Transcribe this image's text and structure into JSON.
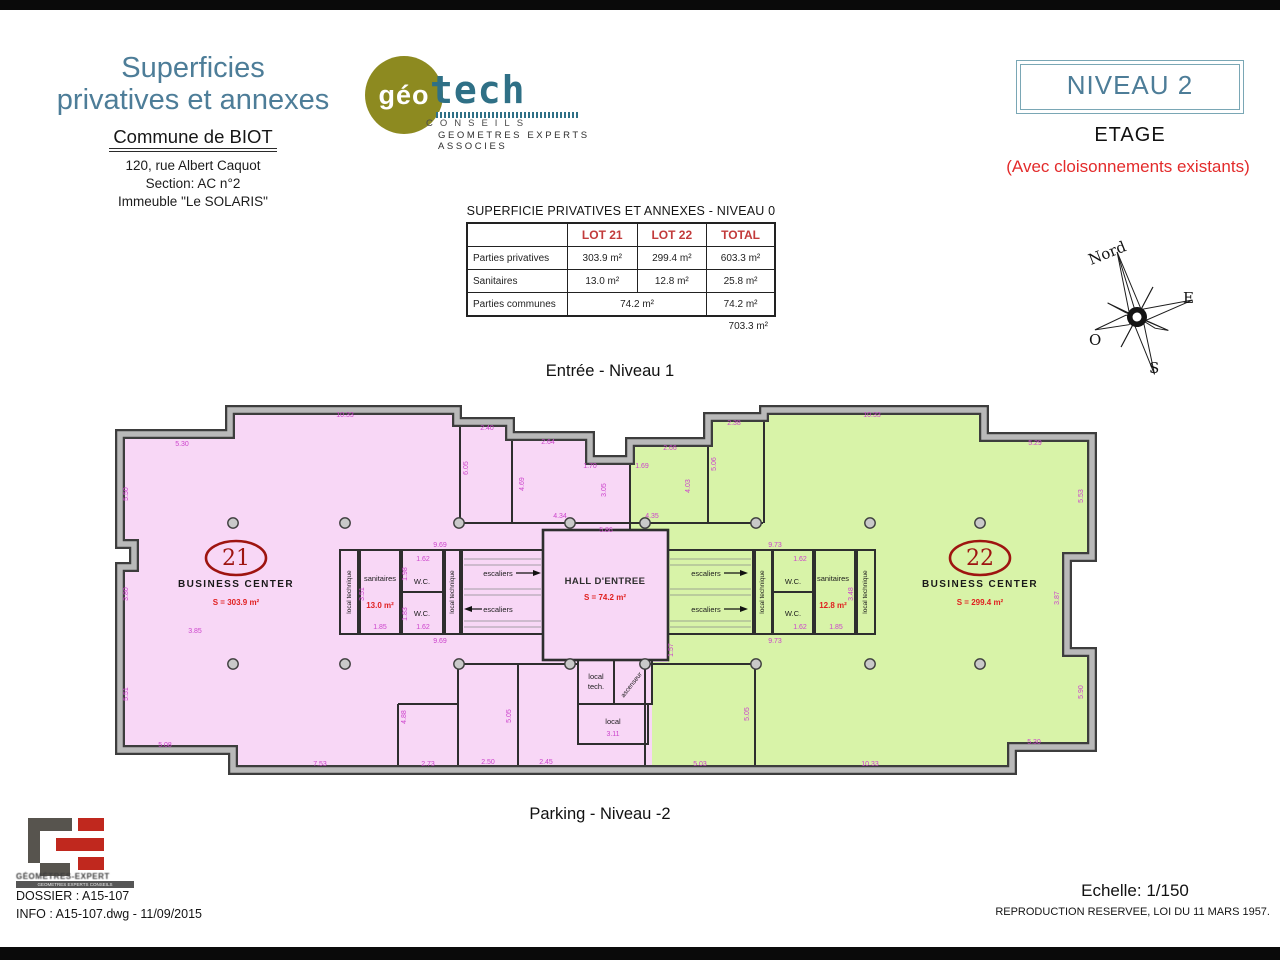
{
  "header": {
    "title_line1": "Superficies",
    "title_line2": "privatives et annexes",
    "commune": "Commune de BIOT",
    "address1": "120, rue Albert Caquot",
    "address2": "Section: AC n°2",
    "address3": "Immeuble \"Le SOLARIS\""
  },
  "logo": {
    "geo": "géo",
    "tech": "tech",
    "conseils": "CONSEILS",
    "subtitle": "GEOMETRES EXPERTS ASSOCIES"
  },
  "level": {
    "niveau": "NIVEAU 2",
    "etage": "ETAGE",
    "note": "(Avec cloisonnements existants)"
  },
  "table": {
    "title": "SUPERFICIE PRIVATIVES ET ANNEXES - NIVEAU 0",
    "col_headers": [
      "",
      "LOT 21",
      "LOT 22",
      "TOTAL"
    ],
    "rows": [
      {
        "label": "Parties privatives",
        "span2": false,
        "cells": [
          "303.9 m²",
          "299.4 m²",
          "603.3 m²"
        ]
      },
      {
        "label": "Sanitaires",
        "span2": false,
        "cells": [
          "13.0 m²",
          "12.8 m²",
          "25.8 m²"
        ]
      },
      {
        "label": "Parties communes",
        "span2": true,
        "cells": [
          "74.2 m²",
          "74.2 m²"
        ]
      }
    ],
    "grand_total": "703.3 m²"
  },
  "compass": {
    "n": "Nord",
    "e": "E",
    "s": "S",
    "o": "O"
  },
  "plan": {
    "entry": "Entrée - Niveau 1",
    "parking": "Parking - Niveau -2",
    "columns": {
      "xs": [
        121,
        233,
        347,
        458,
        533,
        644,
        758,
        868
      ],
      "ys": [
        121,
        262
      ]
    },
    "labels": [
      {
        "t": "21",
        "x": 124,
        "y": 163,
        "cls": "num"
      },
      {
        "t": "BUSINESS CENTER",
        "x": 124,
        "y": 185,
        "cls": "name"
      },
      {
        "t": "S = 303.9 m²",
        "x": 124,
        "y": 203,
        "cls": "area"
      },
      {
        "t": "22",
        "x": 868,
        "y": 163,
        "cls": "num"
      },
      {
        "t": "BUSINESS CENTER",
        "x": 868,
        "y": 185,
        "cls": "name"
      },
      {
        "t": "S = 299.4 m²",
        "x": 868,
        "y": 203,
        "cls": "area"
      },
      {
        "t": "HALL D'ENTREE",
        "x": 493,
        "y": 182,
        "cls": "hall"
      },
      {
        "t": "S = 74.2 m²",
        "x": 493,
        "y": 198,
        "cls": "area"
      },
      {
        "t": "escaliers",
        "x": 386,
        "y": 174,
        "cls": "room"
      },
      {
        "t": "escaliers",
        "x": 386,
        "y": 210,
        "cls": "room"
      },
      {
        "t": "escaliers",
        "x": 594,
        "y": 174,
        "cls": "room"
      },
      {
        "t": "escaliers",
        "x": 594,
        "y": 210,
        "cls": "room"
      },
      {
        "t": "sanitaires",
        "x": 268,
        "y": 179,
        "cls": "room"
      },
      {
        "t": "13.0 m²",
        "x": 268,
        "y": 206,
        "cls": "area"
      },
      {
        "t": "W.C.",
        "x": 310,
        "y": 182,
        "cls": "room"
      },
      {
        "t": "W.C.",
        "x": 310,
        "y": 214,
        "cls": "room"
      },
      {
        "t": "W.C.",
        "x": 681,
        "y": 182,
        "cls": "room"
      },
      {
        "t": "W.C.",
        "x": 681,
        "y": 214,
        "cls": "room"
      },
      {
        "t": "sanitaires",
        "x": 721,
        "y": 179,
        "cls": "room"
      },
      {
        "t": "12.8 m²",
        "x": 721,
        "y": 206,
        "cls": "area"
      },
      {
        "t": "local technique",
        "x": 239,
        "y": 190,
        "cls": "roomv",
        "r": -90
      },
      {
        "t": "local technique",
        "x": 342,
        "y": 190,
        "cls": "roomv",
        "r": -90
      },
      {
        "t": "local technique",
        "x": 652,
        "y": 190,
        "cls": "roomv",
        "r": -90
      },
      {
        "t": "local technique",
        "x": 755,
        "y": 190,
        "cls": "roomv",
        "r": -90
      },
      {
        "t": "local",
        "x": 484,
        "y": 277,
        "cls": "room"
      },
      {
        "t": "tech.",
        "x": 484,
        "y": 287,
        "cls": "room"
      },
      {
        "t": "ascenseur",
        "x": 521,
        "y": 284,
        "cls": "roomv",
        "r": -52
      },
      {
        "t": "local",
        "x": 501,
        "y": 322,
        "cls": "room"
      }
    ],
    "dims": [
      {
        "t": "5.30",
        "x": 70,
        "y": 44
      },
      {
        "t": "10.33",
        "x": 233,
        "y": 15
      },
      {
        "t": "2.40",
        "x": 375,
        "y": 28
      },
      {
        "t": "2.64",
        "x": 436,
        "y": 42
      },
      {
        "t": "1.70",
        "x": 478,
        "y": 66
      },
      {
        "t": "1.69",
        "x": 530,
        "y": 66
      },
      {
        "t": "2.66",
        "x": 558,
        "y": 48
      },
      {
        "t": "2.38",
        "x": 622,
        "y": 23
      },
      {
        "t": "10.33",
        "x": 760,
        "y": 15
      },
      {
        "t": "5.29",
        "x": 923,
        "y": 43
      },
      {
        "t": "5.50",
        "x": 16,
        "y": 92,
        "r": -90
      },
      {
        "t": "3.80",
        "x": 16,
        "y": 192,
        "r": -90
      },
      {
        "t": "5.51",
        "x": 16,
        "y": 292,
        "r": -90
      },
      {
        "t": "6.05",
        "x": 356,
        "y": 66,
        "r": -90
      },
      {
        "t": "4.69",
        "x": 412,
        "y": 82,
        "r": -90
      },
      {
        "t": "3.05",
        "x": 494,
        "y": 88,
        "r": -90
      },
      {
        "t": "4.03",
        "x": 578,
        "y": 84,
        "r": -90
      },
      {
        "t": "5.06",
        "x": 604,
        "y": 62,
        "r": -90
      },
      {
        "t": "4.34",
        "x": 448,
        "y": 116
      },
      {
        "t": "4.35",
        "x": 540,
        "y": 116
      },
      {
        "t": "5.86",
        "x": 494,
        "y": 130
      },
      {
        "t": "9.69",
        "x": 328,
        "y": 145
      },
      {
        "t": "9.69",
        "x": 328,
        "y": 241
      },
      {
        "t": "9.73",
        "x": 663,
        "y": 145
      },
      {
        "t": "9.73",
        "x": 663,
        "y": 241
      },
      {
        "t": "1.62",
        "x": 311,
        "y": 159
      },
      {
        "t": "1.62",
        "x": 311,
        "y": 227
      },
      {
        "t": "1.85",
        "x": 268,
        "y": 227
      },
      {
        "t": "1.98",
        "x": 295,
        "y": 172,
        "r": -90
      },
      {
        "t": "1.83",
        "x": 295,
        "y": 212,
        "r": -90
      },
      {
        "t": "3.51",
        "x": 252,
        "y": 192,
        "r": -90
      },
      {
        "t": "1.62",
        "x": 688,
        "y": 159
      },
      {
        "t": "1.62",
        "x": 688,
        "y": 227
      },
      {
        "t": "1.85",
        "x": 724,
        "y": 227
      },
      {
        "t": "3.48",
        "x": 741,
        "y": 192,
        "r": -90
      },
      {
        "t": "5.53",
        "x": 971,
        "y": 94,
        "r": -90
      },
      {
        "t": "3.87",
        "x": 947,
        "y": 196,
        "r": -90
      },
      {
        "t": "5.90",
        "x": 971,
        "y": 290,
        "r": -90
      },
      {
        "t": "1.57",
        "x": 561,
        "y": 248,
        "r": -90
      },
      {
        "t": "3.85",
        "x": 83,
        "y": 231
      },
      {
        "t": "5.08",
        "x": 53,
        "y": 345
      },
      {
        "t": "7.53",
        "x": 208,
        "y": 364
      },
      {
        "t": "2.73",
        "x": 316,
        "y": 364
      },
      {
        "t": "2.50",
        "x": 376,
        "y": 362
      },
      {
        "t": "2.45",
        "x": 434,
        "y": 362
      },
      {
        "t": "4.88",
        "x": 294,
        "y": 315,
        "r": -90
      },
      {
        "t": "5.05",
        "x": 399,
        "y": 314,
        "r": -90
      },
      {
        "t": "3.11",
        "x": 501,
        "y": 334
      },
      {
        "t": "5.03",
        "x": 588,
        "y": 364
      },
      {
        "t": "10.33",
        "x": 758,
        "y": 364
      },
      {
        "t": "5.30",
        "x": 922,
        "y": 342
      },
      {
        "t": "5.05",
        "x": 637,
        "y": 312,
        "r": -90
      }
    ]
  },
  "footer": {
    "logo_line1": "GÉOMÈTRES-EXPERT",
    "logo_line2": "GEOMETRES EXPERTS CONSEILS",
    "dossier": "DOSSIER : A15-107",
    "info": "INFO : A15-107.dwg - 11/09/2015",
    "echelle": "Echelle: 1/150",
    "copyright": "REPRODUCTION RESERVEE, LOI DU 11 MARS 1957."
  }
}
